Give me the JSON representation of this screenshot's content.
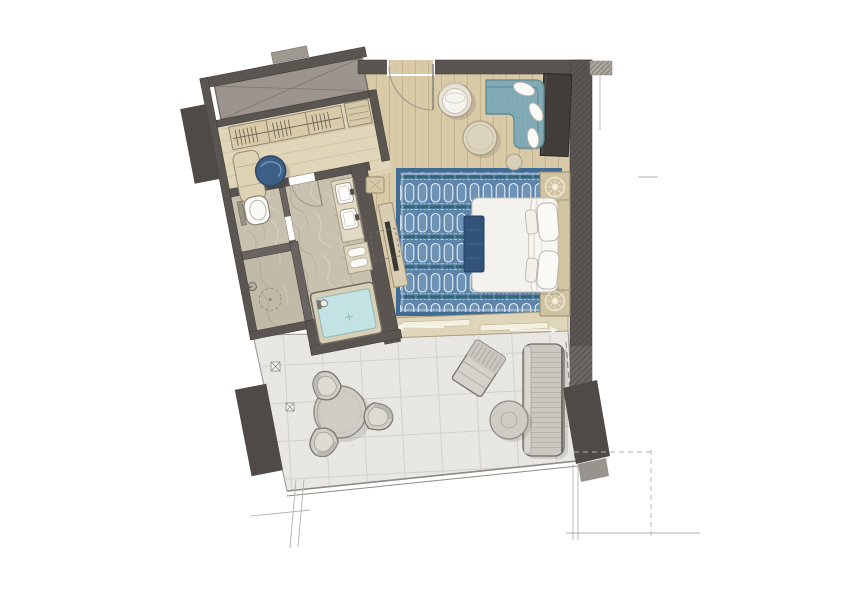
{
  "document": {
    "type": "architectural floor plan",
    "title": "Hotel Suite Floor Plan",
    "description": "Top-down rendered plan of a hotel suite with dressing area, bathroom, WC, shower, bedroom, sitting area and a large terrace",
    "background": "#ffffff"
  },
  "palette": {
    "wall": "#5a5551",
    "wall_stroke": "#3c3835",
    "wall_hatch_light": "#aaa69f",
    "pillar": "#4f4a46",
    "wood_base": "#d9caa8",
    "wood_line": "#c2b18d",
    "wood_light_base": "#e2d6ba",
    "wood_light_line": "#cdbf9c",
    "marble_base": "#c9c1b0",
    "marble_vein_dark": "#aba28f",
    "marble_vein_light": "#dbd5c7",
    "shower_base": "#c2baa8",
    "tile_base": "#e8e7e3",
    "tile_line": "#d1cec8",
    "rug_base": "#5e85a9",
    "rug_border": "#3f6b95",
    "rug_arch_fill": "#6e93b4",
    "rug_arch_stroke": "#e9eff5",
    "rug_band": "#2d6371",
    "water": "#c3e2e3",
    "sofa": "#81aab4",
    "sofa_line": "#5d8894",
    "bed_white": "#f8f6f2",
    "duvet": "#f4f2ec",
    "bench_navy": "#32527a",
    "nightstand": "#d0c3a1",
    "medallion": "#f6f1e2",
    "headboard": "#d2c5a4",
    "desk_dark": "#423d39",
    "ottoman_blue": "#3e5f85",
    "wardrobe": "#d9cbaa",
    "xbox_gray": "#9b958d",
    "counter": "#e3dac4",
    "sliding_band": "#dfd5b8",
    "outdoor_gray": "#d0cdc6",
    "outdoor_stroke": "#7b776f",
    "annotation": "#b4b1ab"
  },
  "rooms": [
    {
      "name": "Sitting Area",
      "floor": "wood planks",
      "furniture": [
        "l-shaped-sofa",
        "round-lounge-chair",
        "round-coffee-table",
        "round-side-table",
        "console-desk"
      ]
    },
    {
      "name": "Bedroom",
      "floor": "wood planks",
      "furniture": [
        "double-bed",
        "foot-bench",
        "nightstand-top",
        "nightstand-bottom",
        "patterned-area-rug",
        "tv-console",
        "stool"
      ]
    },
    {
      "name": "Dressing Area",
      "floor": "light wood",
      "furniture": [
        "wardrobe-with-hangers",
        "luggage-bench",
        "chaise-bench",
        "round-ottoman"
      ]
    },
    {
      "name": "Bathroom",
      "floor": "marble",
      "furniture": [
        "double-vanity",
        "towel-shelf",
        "bathtub"
      ]
    },
    {
      "name": "WC",
      "floor": "marble",
      "furniture": [
        "toilet"
      ]
    },
    {
      "name": "Shower",
      "floor": "stone",
      "furniture": [
        "shower-head",
        "floor-drain"
      ]
    },
    {
      "name": "Terrace",
      "floor": "stone tiles",
      "furniture": [
        "outdoor-dining-table",
        "outdoor-chairs-x3",
        "sun-lounger",
        "outdoor-daybed",
        "outdoor-side-table"
      ]
    }
  ],
  "architecture": {
    "entry": "hinged entry door in top wall with quarter-circle swing",
    "terrace_access": "sliding glass door with direction arrows",
    "structure": [
      "shaft-void-with-x",
      "column-north-west",
      "column-south-west",
      "hatched-exterior-walls",
      "terrace-railing",
      "dashed-property-lines"
    ]
  }
}
